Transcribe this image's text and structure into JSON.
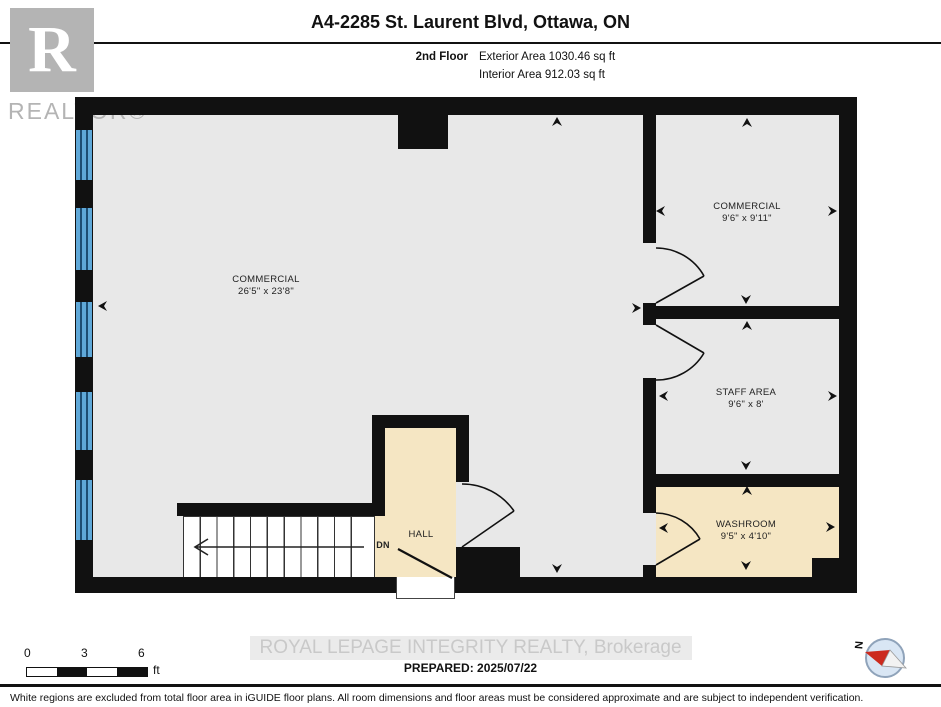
{
  "header": {
    "title": "A4-2285 St. Laurent Blvd, Ottawa, ON",
    "floor_label": "2nd Floor",
    "exterior_area": "Exterior Area 1030.46 sq ft",
    "interior_area": "Interior Area 912.03 sq ft"
  },
  "logo": {
    "letter": "R",
    "word": "REALTOR®"
  },
  "rooms": [
    {
      "name": "COMMERCIAL",
      "dims": "26'5\" x 23'8\""
    },
    {
      "name": "COMMERCIAL",
      "dims": "9'6\" x 9'11\""
    },
    {
      "name": "STAFF AREA",
      "dims": "9'6\" x 8'"
    },
    {
      "name": "WASHROOM",
      "dims": "9'5\" x 4'10\""
    },
    {
      "name": "HALL",
      "dims": ""
    }
  ],
  "stairs": {
    "dn_label": "DN"
  },
  "scale_bar": {
    "tick0": "0",
    "tick1": "3",
    "tick2": "6",
    "unit": "ft"
  },
  "compass": {
    "north_label": "N"
  },
  "footer": {
    "watermark": "ROYAL LEPAGE INTEGRITY REALTY, Brokerage",
    "prepared": "PREPARED: 2025/07/22",
    "disclaimer": "White regions are excluded from total floor area in iGUIDE floor plans. All room dimensions and floor areas must be considered approximate and are subject to independent verification."
  },
  "colors": {
    "wall": "#111111",
    "floor_gray": "#e8e8e8",
    "floor_beige": "#f5e6c3",
    "window_blue": "#5fa8d8",
    "watermark_gray": "#c9c9c9",
    "logo_gray": "#b4b4b4",
    "compass_red": "#cc2a1e"
  }
}
